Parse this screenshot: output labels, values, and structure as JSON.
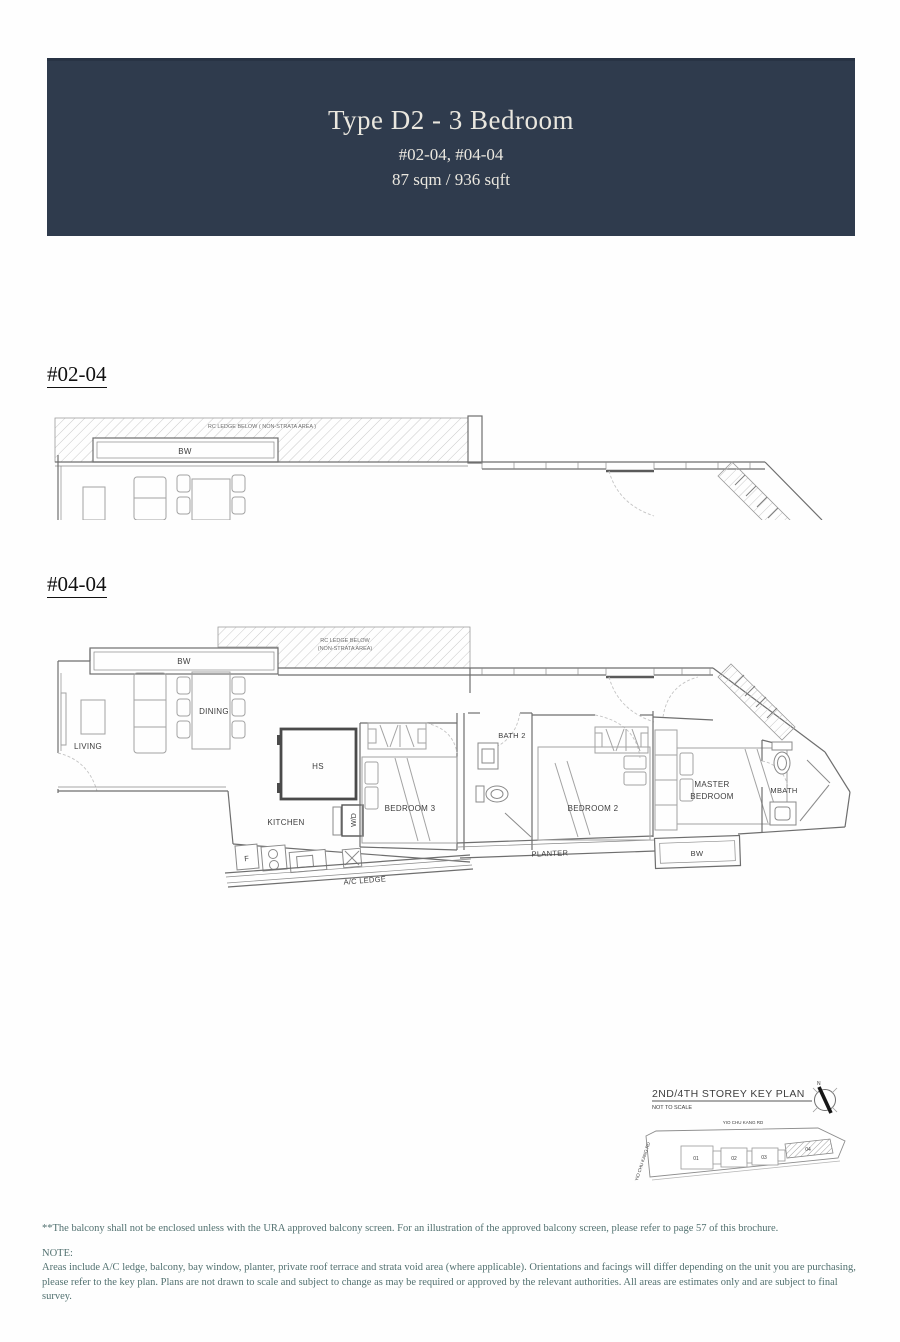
{
  "header": {
    "title": "Type D2 - 3 Bedroom",
    "units": "#02-04, #04-04",
    "area": "87 sqm / 936 sqft"
  },
  "plan_0204": {
    "label": "#02-04",
    "rc_ledge": "RC LEDGE BELOW ( NON-STRATA AREA )",
    "bw": "BW"
  },
  "plan_0404": {
    "label": "#04-04",
    "rc_ledge_1": "RC LEDGE BELOW",
    "rc_ledge_2": "(NON-STRATA AREA)",
    "bw_top": "BW",
    "bw_bottom": "BW",
    "living": "LIVING",
    "dining": "DINING",
    "kitchen": "KITCHEN",
    "hs": "HS",
    "wd": "W/D",
    "fridge": "F",
    "bedroom3": "BEDROOM 3",
    "bath2": "BATH 2",
    "bedroom2": "BEDROOM 2",
    "master_1": "MASTER",
    "master_2": "BEDROOM",
    "mbath": "MBATH",
    "planter": "PLANTER",
    "ac_ledge": "A/C LEDGE"
  },
  "key_plan": {
    "title": "2ND/4TH STOREY KEY PLAN",
    "scale_note": "NOT TO SCALE",
    "north": "N",
    "road_top": "YIO CHU KANG RD",
    "road_left": "YIO CHU KANG RD",
    "units": [
      "01",
      "02",
      "03",
      "04"
    ]
  },
  "footer": {
    "balcony_note": "**The balcony shall not be enclosed unless with the URA approved balcony screen. For an illustration of the approved balcony screen, please refer to page 57 of this brochure.",
    "note_label": "NOTE:",
    "note_line1": "Areas include A/C ledge, balcony, bay window, planter, private roof terrace and strata void area (where applicable). Orientations and facings will differ depending on the unit you are purchasing,",
    "note_line2": "please refer to the key plan. Plans are not drawn to scale and subject to change as may be required or approved by the relevant authorities. All areas are estimates only and are subject to final survey."
  },
  "colors": {
    "header_bg": "#2f3b4d",
    "header_text": "#eae7df",
    "footer_text": "#527170"
  }
}
